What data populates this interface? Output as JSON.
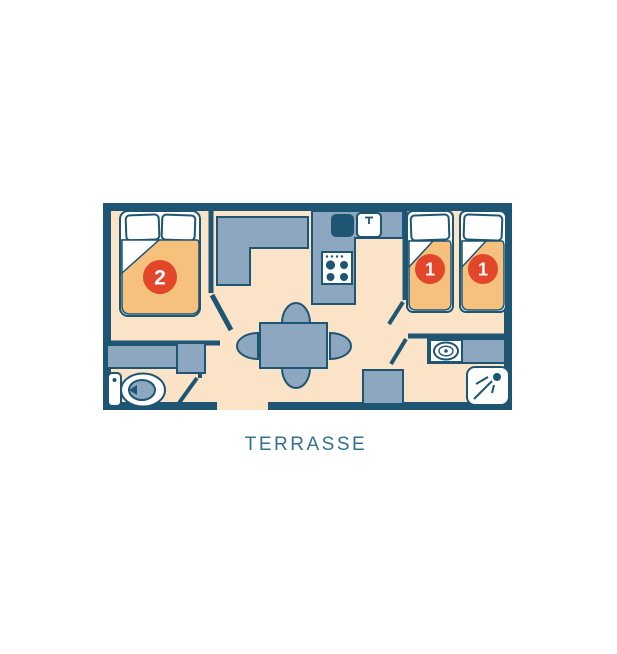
{
  "colors": {
    "wall": "#1d5573",
    "floor": "#fbe3c8",
    "furniture": "#8ca7bf",
    "white": "#ffffff",
    "bed": "#f5c17c",
    "bed_edge": "#1d5573",
    "badge": "#e2462b",
    "label": "#34708f"
  },
  "plan": {
    "terrace_label": "TERRASSE",
    "bedroom_double": {
      "badge": "2"
    },
    "bedroom_twin": {
      "badge_left": "1",
      "badge_right": "1"
    }
  },
  "icons": {
    "double_bed": "double-bed-icon",
    "single_bed": "single-bed-icon",
    "stove": "stove-icon",
    "kitchen_sink_basin": "sink-basin-icon",
    "kitchen_sink_faucet": "faucet-icon",
    "dining_table": "dining-table-icon",
    "chair": "chair-icon",
    "wardrobe": "wardrobe-icon",
    "toilet": "toilet-icon",
    "washbasin": "washbasin-icon",
    "shower": "shower-icon",
    "door": "door-leaf-icon"
  }
}
